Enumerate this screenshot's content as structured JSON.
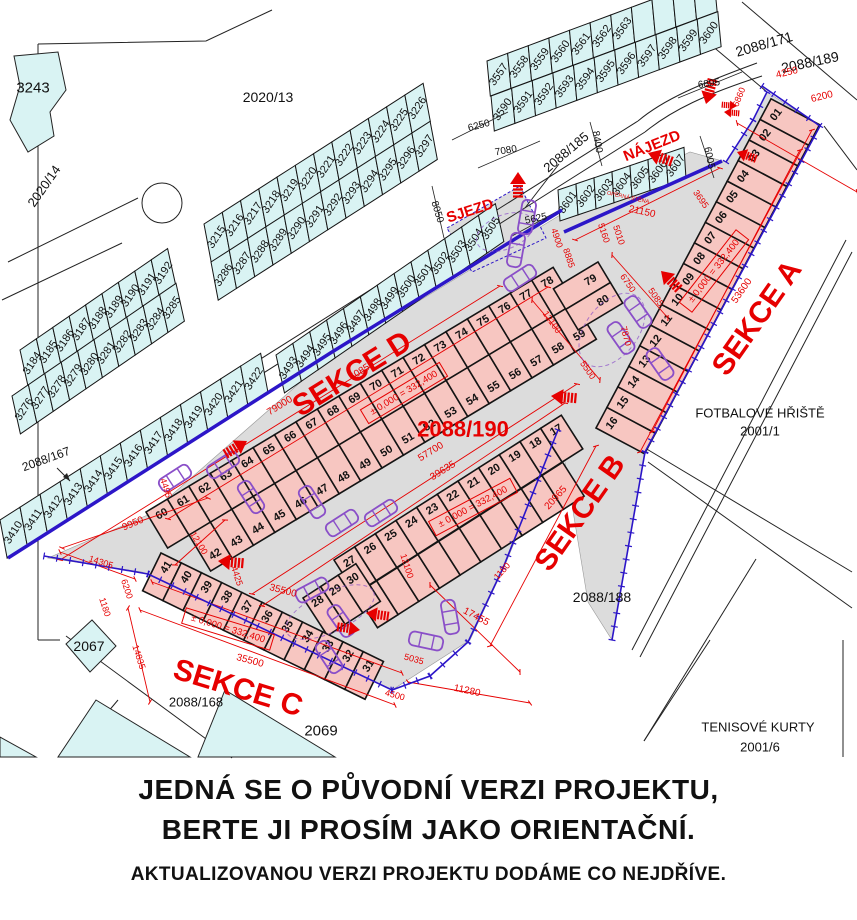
{
  "page": {
    "background": "#ffffff"
  },
  "colors": {
    "teal": "#d9f3f3",
    "pink": "#f7c6c1",
    "gray": "#dcdcdc",
    "blue": "#2c16c8",
    "red": "#e60000",
    "purple": "#8a4fc8",
    "yellow": "#d7e23c",
    "line": "#222222",
    "text": "#111111"
  },
  "parcels": {
    "strip_3184": [
      "3184",
      "3185",
      "3186",
      "3187",
      "3188",
      "3189",
      "3190",
      "3191",
      "3192"
    ],
    "strip_3276": [
      "3276",
      "3277",
      "3278",
      "3279",
      "3280",
      "3281",
      "3282",
      "3283",
      "3284",
      "3285"
    ],
    "strip_3215": [
      "3215",
      "3216",
      "3217",
      "3218",
      "3219",
      "3220",
      "3221",
      "3222",
      "3223",
      "3224",
      "3225",
      "3226"
    ],
    "strip_3286": [
      "3286",
      "3287",
      "3288",
      "3289",
      "3290",
      "3291",
      "3292",
      "3293",
      "3294",
      "3295",
      "3296",
      "3297"
    ],
    "strip_3557": [
      "3557",
      "3558",
      "3559",
      "3560",
      "3561",
      "3562",
      "3563",
      "",
      "",
      "",
      ""
    ],
    "strip_3590": [
      "3590",
      "3591",
      "3592",
      "3593",
      "3594",
      "3595",
      "3596",
      "3597",
      "3598",
      "3599",
      "3600"
    ],
    "strip_3601": [
      "3601",
      "3602",
      "3603",
      "3604",
      "3605",
      "3606",
      "3607"
    ],
    "strip_3410": [
      "3410",
      "3411",
      "3412",
      "3413",
      "3414",
      "3415",
      "3416",
      "3417",
      "3418",
      "3419",
      "3420",
      "3421",
      "3422"
    ],
    "strip_3493": [
      "3493",
      "3494",
      "3495",
      "3496",
      "3497",
      "3498",
      "3499",
      "3500",
      "3501",
      "3502",
      "3503",
      "3504",
      "3505"
    ]
  },
  "garages": {
    "sekce_a": [
      "16",
      "15",
      "14",
      "13",
      "12",
      "11",
      "10",
      "09",
      "08",
      "07",
      "06",
      "05",
      "04",
      "03",
      "02",
      "01"
    ],
    "row_60_78": [
      "60",
      "61",
      "62",
      "63",
      "64",
      "65",
      "66",
      "67",
      "68",
      "69",
      "70",
      "71",
      "72",
      "73",
      "74",
      "75",
      "76",
      "77",
      "78"
    ],
    "row_42_59": [
      "42",
      "43",
      "44",
      "45",
      "46",
      "47",
      "48",
      "49",
      "50",
      "51",
      "52",
      "53",
      "54",
      "55",
      "56",
      "57",
      "58",
      "59"
    ],
    "row_79_80": [
      "79",
      "80"
    ],
    "row_b": [
      "27",
      "26",
      "25",
      "24",
      "23",
      "22",
      "21",
      "20",
      "19",
      "18",
      "17"
    ],
    "row_28_30": [
      "28",
      "29",
      "30"
    ],
    "sekce_c": [
      "41",
      "40",
      "39",
      "38",
      "37",
      "36",
      "35",
      "34",
      "33",
      "32",
      "31"
    ]
  },
  "labels": {
    "black": [
      [
        "3243",
        33,
        88,
        0,
        15
      ],
      [
        "2020/14",
        44,
        186,
        -55,
        13
      ],
      [
        "2020/13",
        268,
        97,
        0,
        14
      ],
      [
        "2088/171",
        764,
        44,
        -16,
        14
      ],
      [
        "2088/189",
        810,
        62,
        -12,
        14
      ],
      [
        "2088/185",
        566,
        152,
        -40,
        13
      ],
      [
        "2088/167",
        46,
        459,
        -20,
        12
      ],
      [
        "2088/188",
        602,
        597,
        0,
        14
      ],
      [
        "2088/168",
        196,
        702,
        0,
        13
      ],
      [
        "2067",
        89,
        646,
        0,
        14
      ],
      [
        "2069",
        321,
        731,
        0,
        15
      ],
      [
        "FOTBALOVÉ HŘIŠTĚ",
        760,
        413,
        0,
        13
      ],
      [
        "2001/1",
        760,
        431,
        0,
        13
      ],
      [
        "TENISOVÉ KURTY",
        758,
        727,
        0,
        13
      ],
      [
        "2001/6",
        760,
        747,
        0,
        13
      ],
      [
        "6250",
        479,
        126,
        -15,
        10
      ],
      [
        "7080",
        506,
        151,
        -10,
        10
      ],
      [
        "8050",
        437,
        212,
        73,
        10
      ],
      [
        "8400",
        597,
        142,
        80,
        10
      ],
      [
        "5625",
        536,
        219,
        -12,
        10
      ],
      [
        "6895",
        709,
        84,
        -8,
        10
      ],
      [
        "6005",
        709,
        158,
        78,
        10
      ]
    ],
    "red": [
      [
        "NÁJEZD",
        652,
        146,
        -22,
        15,
        1
      ],
      [
        "SJEZD",
        470,
        211,
        -18,
        15,
        1
      ],
      [
        "SEKCE A",
        757,
        318,
        -55,
        30,
        1
      ],
      [
        "SEKCE B",
        580,
        513,
        -55,
        30,
        1
      ],
      [
        "SEKCE C",
        238,
        688,
        17,
        30,
        1
      ],
      [
        "SEKCE D",
        352,
        374,
        -32,
        30,
        1
      ],
      [
        "2088/190",
        463,
        429,
        0,
        22,
        1
      ],
      [
        "21150",
        642,
        212,
        12,
        10
      ],
      [
        "OPĚRNÁ STĚNA",
        628,
        198,
        12,
        5.5
      ],
      [
        "5160",
        604,
        233,
        72,
        9
      ],
      [
        "5010",
        619,
        235,
        72,
        9
      ],
      [
        "4900",
        557,
        238,
        72,
        9
      ],
      [
        "8885",
        569,
        258,
        72,
        9
      ],
      [
        "6750",
        628,
        283,
        55,
        9
      ],
      [
        "5085",
        656,
        297,
        55,
        9
      ],
      [
        "3695",
        701,
        199,
        55,
        9
      ],
      [
        "4250",
        787,
        73,
        -14,
        10
      ],
      [
        "6200",
        822,
        97,
        -14,
        10
      ],
      [
        "6860",
        739,
        97,
        -68,
        9
      ],
      [
        "53600",
        742,
        291,
        -55,
        10
      ],
      [
        "7870",
        626,
        336,
        75,
        9
      ],
      [
        "79000",
        280,
        406,
        -32,
        10
      ],
      [
        "60850",
        362,
        371,
        -32,
        10
      ],
      [
        "57700",
        431,
        452,
        -32,
        10
      ],
      [
        "39635",
        443,
        471,
        -32,
        10
      ],
      [
        "12100",
        199,
        543,
        58,
        9
      ],
      [
        "12100",
        407,
        566,
        72,
        9
      ],
      [
        "12100",
        552,
        322,
        55,
        9
      ],
      [
        "5500",
        588,
        370,
        55,
        9
      ],
      [
        "9950",
        133,
        524,
        -23,
        10
      ],
      [
        "4495",
        166,
        488,
        72,
        9
      ],
      [
        "14305",
        101,
        562,
        18,
        9
      ],
      [
        "6200",
        127,
        589,
        72,
        9
      ],
      [
        "1180",
        105,
        607,
        72,
        9
      ],
      [
        "14835",
        139,
        657,
        72,
        9
      ],
      [
        "4425",
        237,
        576,
        72,
        9
      ],
      [
        "35500",
        283,
        591,
        15,
        10
      ],
      [
        "35500",
        250,
        661,
        15,
        10
      ],
      [
        "5035",
        414,
        659,
        15,
        9
      ],
      [
        "4500",
        395,
        695,
        15,
        9
      ],
      [
        "17455",
        476,
        617,
        28,
        10
      ],
      [
        "11280",
        467,
        691,
        12,
        10
      ],
      [
        "20965",
        556,
        498,
        -48,
        10
      ],
      [
        "1180",
        502,
        571,
        -48,
        9
      ]
    ]
  },
  "level_marks": {
    "text": "± 0,000 = 332,400",
    "positions": [
      [
        714,
        271,
        -52
      ],
      [
        404,
        393,
        -31
      ],
      [
        473,
        507,
        -28
      ],
      [
        228,
        629,
        17
      ]
    ]
  },
  "disclaimer": {
    "line1": "JEDNÁ SE O PŮVODNÍ VERZI PROJEKTU,",
    "line2": "BERTE JI PROSÍM JAKO ORIENTAČNÍ.",
    "line3": "AKTUALIZOVANOU VERZI PROJEKTU DODÁME CO NEJDŘÍVE."
  }
}
